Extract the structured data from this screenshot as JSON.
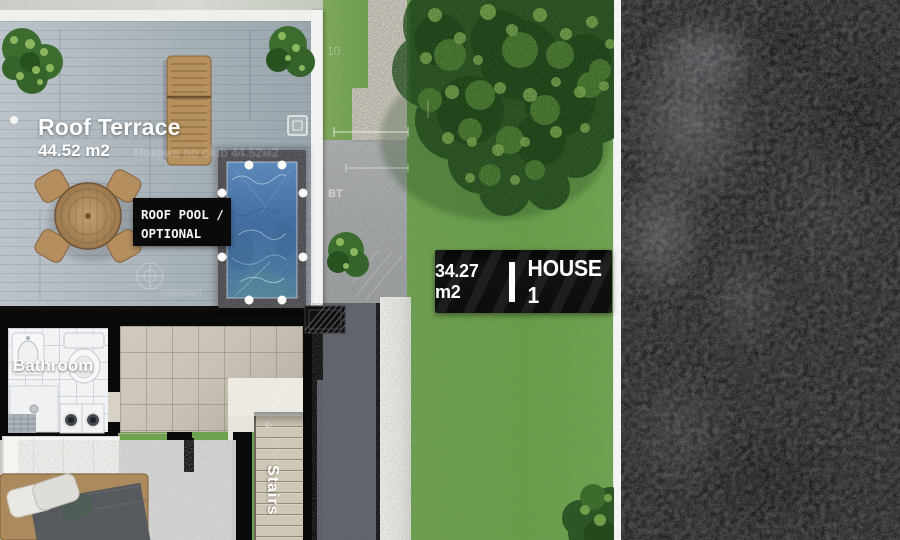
{
  "labels": {
    "roof_terrace": {
      "title": "Roof Terrace",
      "area": "44.52 m2",
      "ghost": "Покрив по club 44.52м2"
    },
    "pool_box": {
      "line1": "ROOF POOL /",
      "line2": "OPTIONAL"
    },
    "house_box": {
      "area": "34.27 m2",
      "name": "HOUSE 1"
    },
    "rooms": {
      "bathroom": "Bathroom",
      "stairs": "Stairs",
      "stairs_ghost": "стълби"
    },
    "annotations": {
      "bt": "BT",
      "ten": "10",
      "parapet": "парапет"
    }
  },
  "colors": {
    "grass": "#6fa24e",
    "tree": "#315c28",
    "treeLight": "#7fae54",
    "pebble": "#dcd8c9",
    "concrete": "#a2a5a6",
    "gravelDark": "#5b616b",
    "walkway": "#e9e9e5",
    "asphalt": "#17181a",
    "water": "#3f6da4",
    "poolSurround": "#46464b",
    "wall": "#0a0a0b",
    "wallWhite": "#f2f3f0",
    "tile": "#c9c2b5",
    "bathTile": "#f2f3f5",
    "step": "#cfc7b5",
    "rug": "#d7d7d5",
    "wood": "#b58e5f",
    "labelBg": "#0a0a0a",
    "labelText": "#f5f5f3"
  }
}
